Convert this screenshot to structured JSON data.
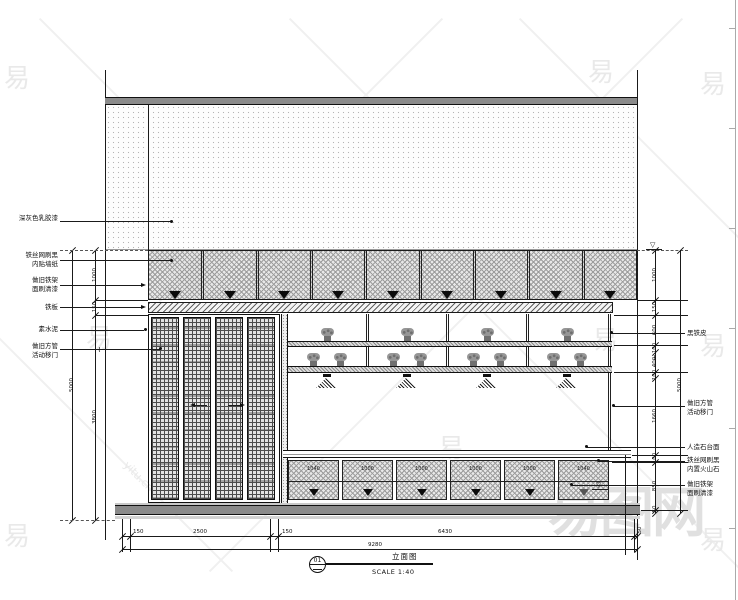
{
  "watermark": {
    "glyph": "易",
    "brand": "易图网",
    "url": "yitu.cn"
  },
  "drawing": {
    "break_symbol": "~",
    "level_symbol": "▽",
    "annotations_left": [
      {
        "lines": [
          "深灰色乳胶漆"
        ]
      },
      {
        "lines": [
          "铁丝网刷黑",
          "内贴墙纸"
        ]
      },
      {
        "lines": [
          "做旧铁架",
          "面刷清漆"
        ]
      },
      {
        "lines": [
          "铁板"
        ]
      },
      {
        "lines": [
          "素水泥"
        ]
      },
      {
        "lines": [
          "做旧方管",
          "活动移门"
        ]
      }
    ],
    "annotations_right": [
      {
        "lines": [
          "黑铁皮"
        ]
      },
      {
        "lines": [
          "做旧方管",
          "活动移门"
        ]
      },
      {
        "lines": [
          "人造石台面"
        ]
      },
      {
        "lines": [
          "铁丝网刷黑",
          "内置火山石"
        ]
      },
      {
        "lines": [
          "做旧铁架",
          "面刷清漆"
        ]
      }
    ],
    "dims": {
      "left_total": "5000",
      "left": [
        "1000",
        "150",
        "3800"
      ],
      "right": [
        "1000",
        "150",
        "600",
        "100",
        "400",
        "100",
        "1660",
        "100",
        "850",
        "50"
      ],
      "right_total": "5000",
      "bottom": [
        "150",
        "2500",
        "150",
        "6430",
        "50"
      ],
      "bottom_total": "9280"
    },
    "counter_panels": [
      "1040",
      "1000",
      "1000",
      "1000",
      "1000",
      "1040"
    ],
    "title_block": {
      "number": "01",
      "title": "立面图",
      "scale": "SCALE 1:40"
    }
  }
}
